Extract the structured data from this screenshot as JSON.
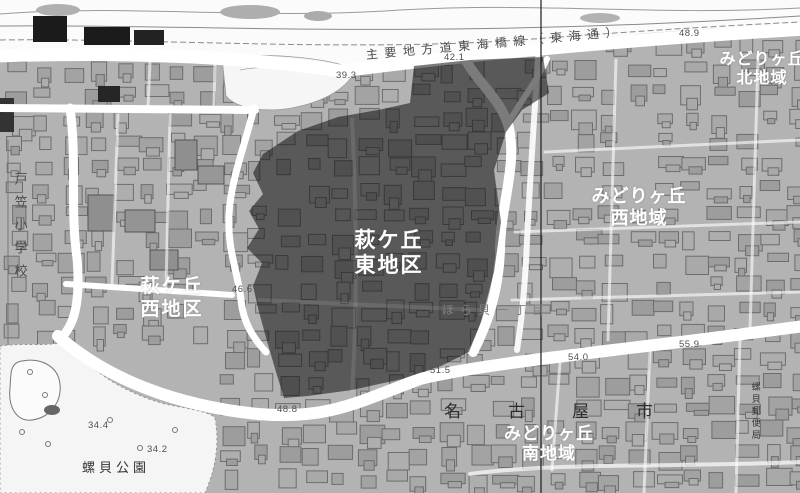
{
  "map": {
    "colors": {
      "base_land": "#b3b3b3",
      "district_shade": "#3f3f3f",
      "road": "#ffffff",
      "district_label_text": "#ffffff",
      "map_text": "#4a4a4a",
      "boundary_line": "#1c1c1c"
    },
    "district_labels": [
      {
        "id": "hagigaoka-east",
        "lines": [
          "萩ケ丘",
          "東地区"
        ]
      },
      {
        "id": "hagigaoka-west",
        "lines": [
          "萩ケ丘",
          "西地区"
        ]
      },
      {
        "id": "midorigaoka-north",
        "lines": [
          "みどりヶ丘",
          "北地域"
        ]
      },
      {
        "id": "midorigaoka-west",
        "lines": [
          "みどりヶ丘",
          "西地域"
        ]
      },
      {
        "id": "midorigaoka-south",
        "lines": [
          "みどりヶ丘",
          "南地域"
        ]
      }
    ],
    "place_labels": [
      {
        "id": "togasa-elementary-school",
        "text": "戸笠小学校",
        "orientation": "vertical"
      },
      {
        "id": "horagai-park",
        "text": "螺貝公園",
        "orientation": "horizontal"
      },
      {
        "id": "horagai-post-office",
        "text": "螺貝郵便局",
        "orientation": "vertical"
      },
      {
        "id": "horagai-1-chome",
        "text": "ほら貝一丁目",
        "orientation": "horizontal"
      },
      {
        "id": "nagoya-city",
        "text": "名古屋市",
        "orientation": "horizontal"
      }
    ],
    "road_labels": [
      {
        "id": "tokai-dori",
        "text": "主要地方道東海橋線（東海通）"
      }
    ],
    "elevation_markers": [
      {
        "value": "39.3"
      },
      {
        "value": "42.1"
      },
      {
        "value": "48.9"
      },
      {
        "value": "46.6"
      },
      {
        "value": "48.8"
      },
      {
        "value": "51.5"
      },
      {
        "value": "54.0"
      },
      {
        "value": "55.9"
      },
      {
        "value": "34.4"
      },
      {
        "value": "34.2"
      }
    ]
  }
}
